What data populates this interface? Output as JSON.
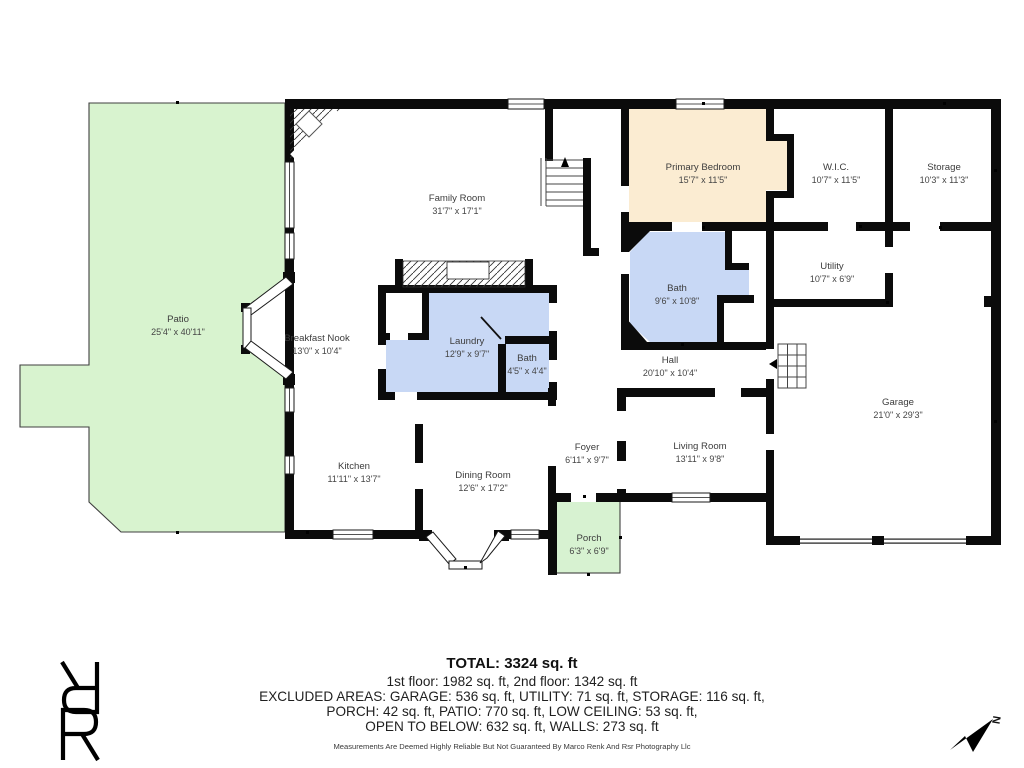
{
  "rooms": [
    {
      "name": "Patio",
      "dims": "25'4\" x 40'11\""
    },
    {
      "name": "Family Room",
      "dims": "31'7\" x 17'1\""
    },
    {
      "name": "Primary Bedroom",
      "dims": "15'7\" x 11'5\""
    },
    {
      "name": "W.I.C.",
      "dims": "10'7\" x 11'5\""
    },
    {
      "name": "Storage",
      "dims": "10'3\" x 11'3\""
    },
    {
      "name": "Bath",
      "dims": "9'6\" x 10'8\""
    },
    {
      "name": "Utility",
      "dims": "10'7\" x 6'9\""
    },
    {
      "name": "Breakfast Nook",
      "dims": "13'0\" x 10'4\""
    },
    {
      "name": "Laundry",
      "dims": "12'9\" x 9'7\""
    },
    {
      "name": "Bath",
      "dims": "4'5\" x 4'4\""
    },
    {
      "name": "Hall",
      "dims": "20'10\" x 10'4\""
    },
    {
      "name": "Garage",
      "dims": "21'0\" x 29'3\""
    },
    {
      "name": "Kitchen",
      "dims": "11'11\" x 13'7\""
    },
    {
      "name": "Dining Room",
      "dims": "12'6\" x 17'2\""
    },
    {
      "name": "Foyer",
      "dims": "6'11\" x 9'7\""
    },
    {
      "name": "Living Room",
      "dims": "13'11\" x 9'8\""
    },
    {
      "name": "Porch",
      "dims": "6'3\" x 6'9\""
    }
  ],
  "summary": {
    "total": "TOTAL: 3324 sq. ft",
    "floors": "1st floor: 1982 sq. ft, 2nd floor: 1342 sq. ft",
    "excluded1": "EXCLUDED AREAS: GARAGE: 536 sq. ft, UTILITY: 71 sq. ft, STORAGE: 116 sq. ft,",
    "excluded2": "PORCH: 42 sq. ft, PATIO: 770 sq. ft, LOW CEILING: 53 sq. ft,",
    "excluded3": "OPEN TO BELOW: 632 sq. ft, WALLS: 273 sq. ft",
    "disclaimer": "Measurements Are Deemed Highly Reliable But Not Guaranteed By Marco Renk And Rsr Photography Llc"
  },
  "compass": {
    "label": "N"
  },
  "colors": {
    "wall": "#0b0b0b",
    "patio_green": "#d8f3cf",
    "porch_green": "#d7f2d1",
    "bath_blue": "#c8d8f5",
    "bedroom_tan": "#fbecd2",
    "label_text": "#3c3c3c"
  }
}
